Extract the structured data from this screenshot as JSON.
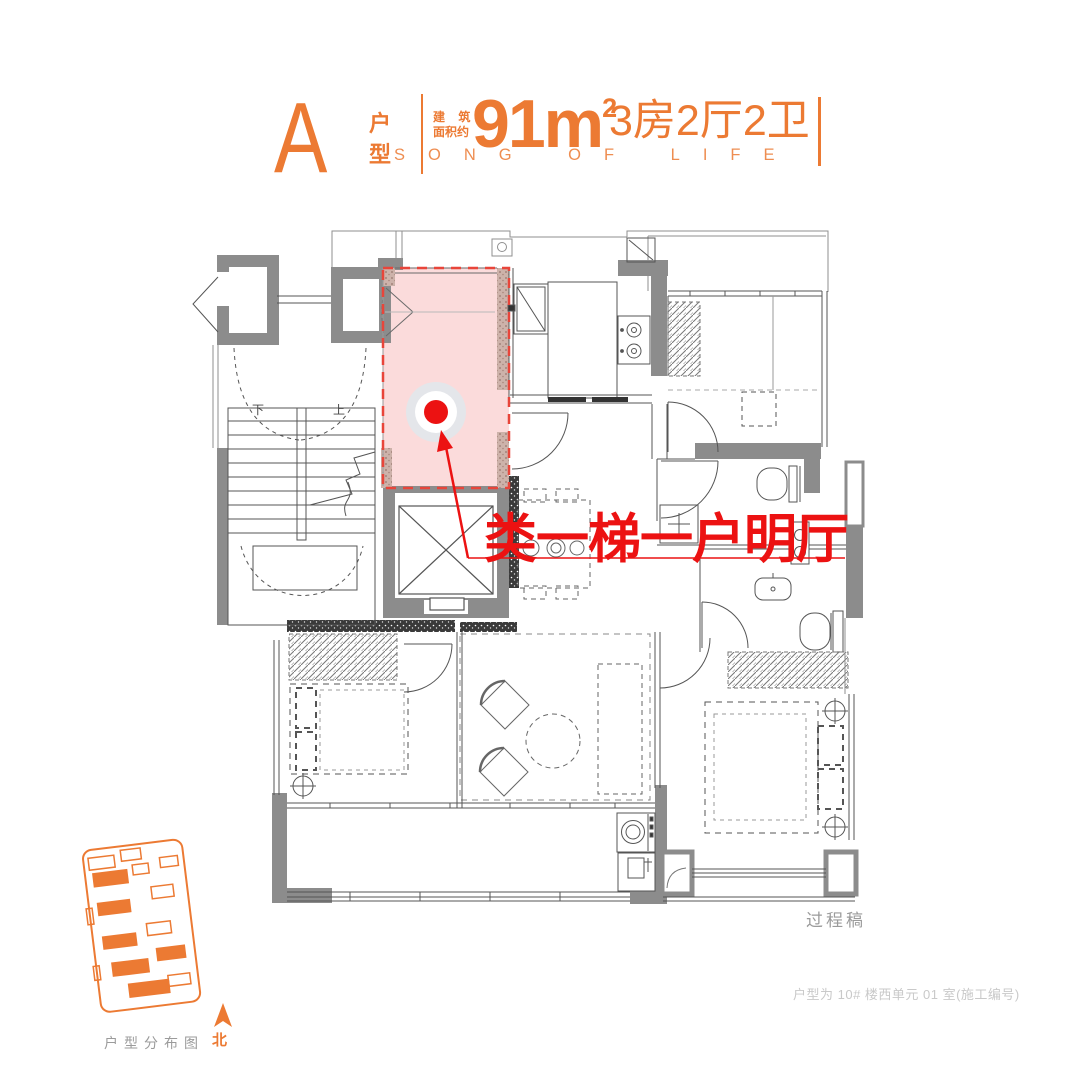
{
  "header": {
    "unit_letter": "A",
    "unit_label": "户型",
    "area_prefix_line1": "建 筑",
    "area_prefix_line2": "面积约",
    "area_value": "91",
    "area_unit": "m",
    "area_power": "2",
    "rooms_text": "3房2厅2卫",
    "slogan": "SONG OF LIFE"
  },
  "annotation": {
    "highlight_text": "类一梯一户明厅"
  },
  "plan": {
    "stair_down_label": "下",
    "stair_up_label": "上"
  },
  "sitemap": {
    "caption": "户型分布图",
    "north_label": "北"
  },
  "footer": {
    "draft_label": "过程稿",
    "unit_note": "户型为 10# 楼西单元 01 室(施工编号)"
  },
  "colors": {
    "accent_orange": "#EC7A33",
    "highlight_red": "#EC1212",
    "highlight_pink": "#FBDBDB",
    "wall_gray": "#8C8C8C"
  }
}
